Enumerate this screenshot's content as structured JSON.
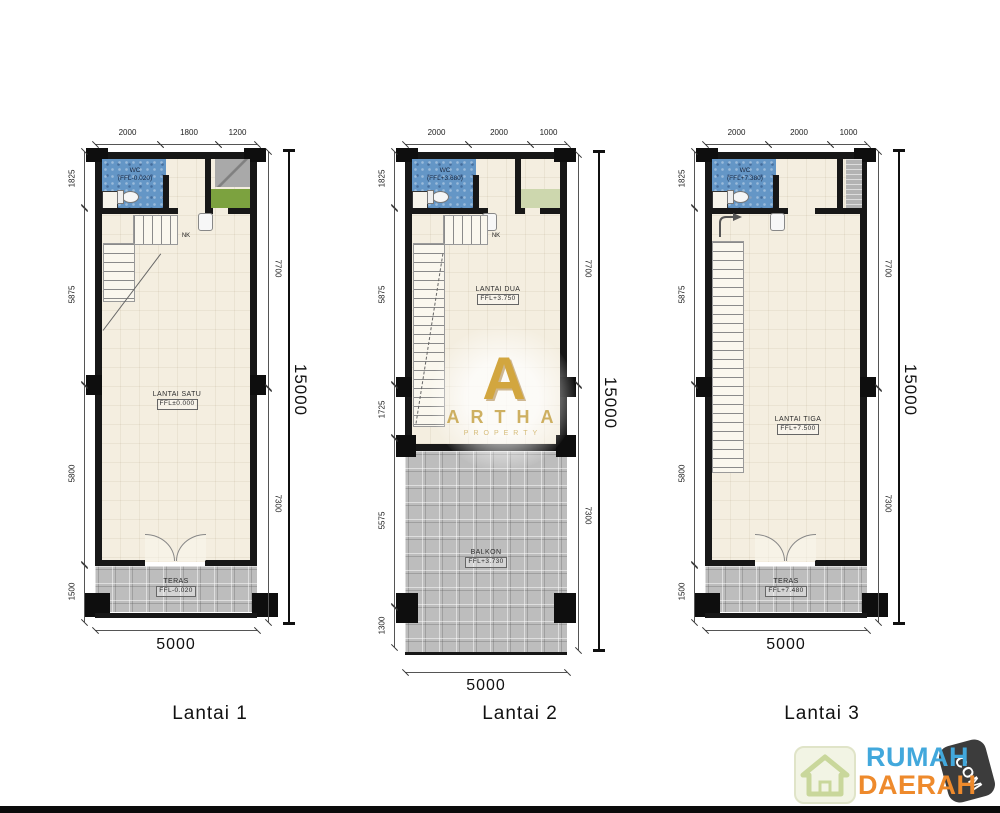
{
  "page": {
    "background": "#ffffff",
    "bottom_bar_color": "#0b0b0b"
  },
  "colors": {
    "wc_tile": "#6496c6",
    "porch_tile": "#bdbdbd",
    "floor": "#f4eee0",
    "planter_green": "#7ca23f",
    "watermark_gold": "#d2a63f",
    "brand_blue": "#42a8dc",
    "brand_orange": "#ee8a2c"
  },
  "watermark": {
    "letter": "A",
    "title": "ARTHA",
    "subtitle": "PROPERTY"
  },
  "brand": {
    "word1": "RUMAH",
    "word2": "DAERAH",
    "badge": ".COM",
    "icon": "house-icon"
  },
  "plans": [
    {
      "caption": "Lantai 1",
      "top_dims": [
        "2000",
        "1800",
        "1200"
      ],
      "left_dims": [
        "1825",
        "5875",
        "5800",
        "1500"
      ],
      "right_dims": [
        "7700",
        "7300"
      ],
      "overall": "15000",
      "bottom": "5000",
      "stair_note": "NK",
      "wc": {
        "name": "WC",
        "ffl": "(FFL-0.020)"
      },
      "room": {
        "name": "LANTAI SATU",
        "ffl": "FFL±0.000"
      },
      "porch": {
        "name": "TERAS",
        "ffl": "FFL-0.020"
      }
    },
    {
      "caption": "Lantai 2",
      "top_dims": [
        "2000",
        "2000",
        "1000"
      ],
      "left_dims": [
        "1825",
        "5875",
        "1725",
        "5575",
        "1300"
      ],
      "right_dims": [
        "7700",
        "7300"
      ],
      "overall": "15000",
      "bottom": "5000",
      "stair_note": "NK",
      "wc": {
        "name": "WC",
        "ffl": "(FFL+3.680)"
      },
      "room": {
        "name": "LANTAI DUA",
        "ffl": "FFL+3.750"
      },
      "porch": {
        "name": "BALKON",
        "ffl": "FFL+3.730"
      }
    },
    {
      "caption": "Lantai 3",
      "top_dims": [
        "2000",
        "2000",
        "1000"
      ],
      "left_dims": [
        "1825",
        "5875",
        "5800",
        "1500"
      ],
      "right_dims": [
        "7700",
        "7300"
      ],
      "overall": "15000",
      "bottom": "5000",
      "stair_note": "NK",
      "wc": {
        "name": "WC",
        "ffl": "(FFL+7.380)"
      },
      "room": {
        "name": "LANTAI TIGA",
        "ffl": "FFL+7.500"
      },
      "porch": {
        "name": "TERAS",
        "ffl": "FFL+7.480"
      }
    }
  ]
}
